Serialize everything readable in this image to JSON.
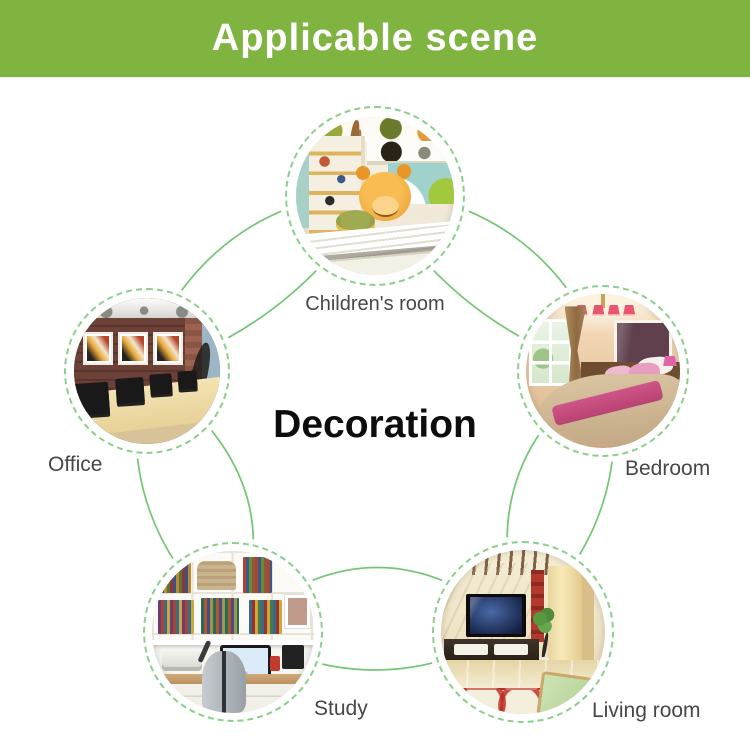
{
  "header": {
    "title": "Applicable scene",
    "bg_color": "#7fb440",
    "text_color": "#ffffff"
  },
  "diagram": {
    "center_label": "Decoration",
    "connector_color": "#74c674",
    "dashed_ring_color": "#8ccf8c",
    "label_color": "#474747",
    "scenes": [
      {
        "label": "Children's room"
      },
      {
        "label": "Office"
      },
      {
        "label": "Bedroom"
      },
      {
        "label": "Study"
      },
      {
        "label": "Living room"
      }
    ]
  }
}
